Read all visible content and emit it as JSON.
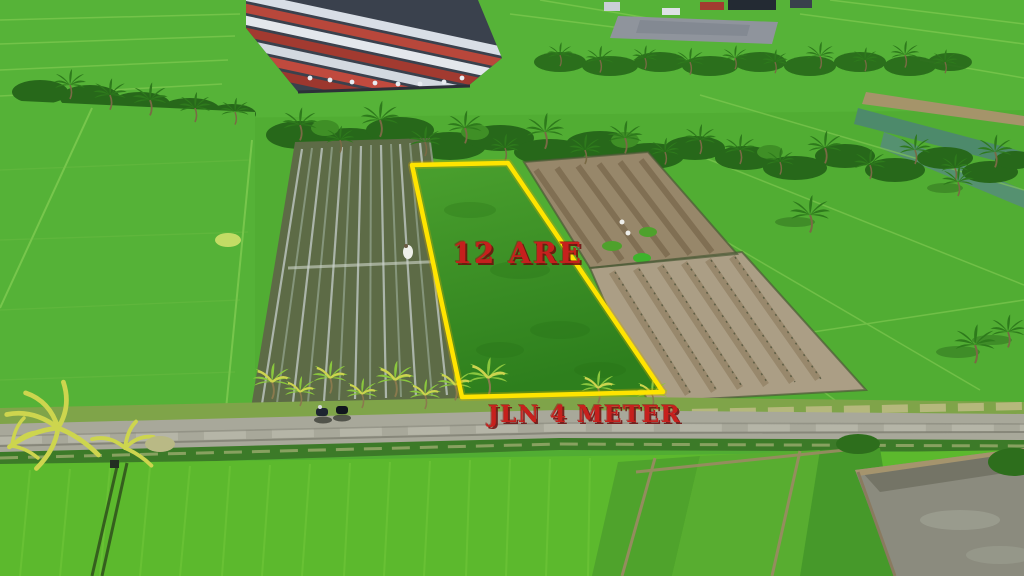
{
  "annotations": {
    "plot_area": {
      "label": "12 ARE"
    },
    "road": {
      "label": "JLN 4 METER"
    }
  },
  "colors": {
    "plot_boundary": "#ffe400",
    "annotation_text": "#c6201d",
    "rice_field_green": "#51ad33",
    "road_gray": "#a8a89a"
  },
  "scene": {
    "type": "aerial drone photo of rice fields with land plot for sale",
    "marked_plot_shape": "trapezoid outlined in yellow"
  }
}
